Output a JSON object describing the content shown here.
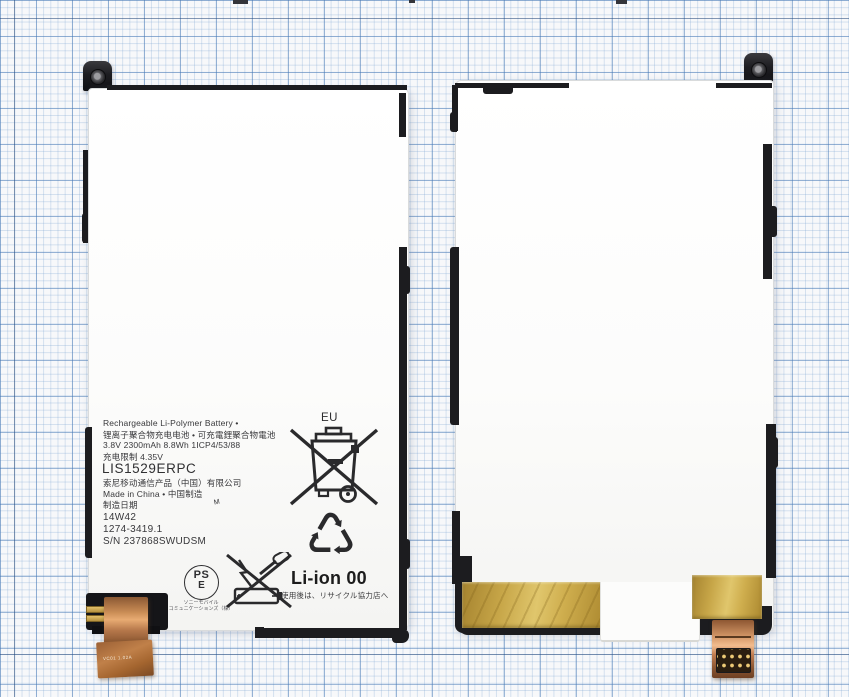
{
  "colors": {
    "paper": "#f7f8fa",
    "grid_minor": "#9db9d9",
    "grid_major": "#4e7ab4",
    "frame_black": "#1c1c1f",
    "battery_white": "#fdfdfc",
    "copper": "#c98c55",
    "gold_tape": "#c7a648",
    "label_text": "#38383b"
  },
  "left_battery": {
    "label": {
      "title": "Rechargeable Li-Polymer Battery •",
      "title_cjk": "锂离子聚合物充电电池 • 可充電鋰聚合物電池",
      "specs": "3.8V 2300mAh 8.8Wh 1ICP4/53/88",
      "charge_limit": "充电限制  4.35V",
      "model": "LIS1529ERPC",
      "manufacturer": "索尼移动通信产品（中国）有限公司",
      "origin": "Made in China • 中国制造",
      "mfg_date_label": "制造日期",
      "date_code": "14W42",
      "part_number": "1274-3419.1",
      "serial": "S/N 237868SWUDSM",
      "handwritten_mark": "M"
    },
    "marks": {
      "eu": "EU",
      "li_ion": "Li-ion 00",
      "recycle_glyph": "♺",
      "recycle_note_jp": "使用後は、リサイクル協力店へ",
      "pse_line1": "PS",
      "pse_line2": "E",
      "pse_company_line1": "ソニーモバイル",
      "pse_company_line2": "コミュニケーションズ（株）"
    },
    "flex": {
      "marking_1": "VC01",
      "marking_2": "1.02A"
    }
  }
}
